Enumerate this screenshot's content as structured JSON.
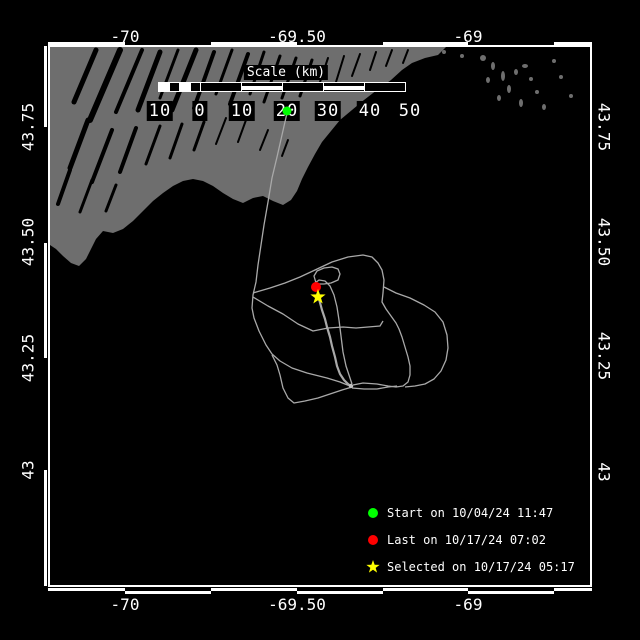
{
  "map": {
    "axes": {
      "top": [
        {
          "label": "-70"
        },
        {
          "label": "-69.50"
        },
        {
          "label": "-69"
        }
      ],
      "bottom": [
        {
          "label": "-70"
        },
        {
          "label": "-69.50"
        },
        {
          "label": "-69"
        }
      ],
      "left": [
        {
          "label": "43.75"
        },
        {
          "label": "43.50"
        },
        {
          "label": "43.25"
        },
        {
          "label": "43"
        }
      ],
      "right": [
        {
          "label": "43.75"
        },
        {
          "label": "43.50"
        },
        {
          "label": "43.25"
        },
        {
          "label": "43"
        }
      ]
    }
  },
  "scalebar": {
    "title": "Scale (km)",
    "tick_labels": [
      "10",
      "0",
      "10",
      "20",
      "30",
      "40",
      "50"
    ]
  },
  "legend": {
    "items": [
      {
        "marker": "circle",
        "color": "#00ff00",
        "label": "Start on 10/04/24 11:47"
      },
      {
        "marker": "circle",
        "color": "#ff0000",
        "label": "Last on 10/17/24 07:02"
      },
      {
        "marker": "star",
        "color": "#ffff00",
        "label": "Selected on 10/17/24 05:17"
      }
    ]
  },
  "markers": {
    "start": {
      "shape": "circle",
      "color": "#00ff00",
      "timestamp": "10/04/24 11:47"
    },
    "last": {
      "shape": "circle",
      "color": "#ff0000",
      "timestamp": "10/17/24 07:02"
    },
    "selected": {
      "shape": "star",
      "color": "#ffff00",
      "timestamp": "10/17/24 05:17"
    }
  },
  "colors": {
    "background": "#000000",
    "land": "#6e6e6e",
    "sea": "#000000",
    "track": "#a9a9a9",
    "track_bright": "#c0c0c0",
    "frame": "#ffffff",
    "text": "#ffffff",
    "start": "#00ff00",
    "last": "#ff0000",
    "selected": "#ffff00"
  }
}
